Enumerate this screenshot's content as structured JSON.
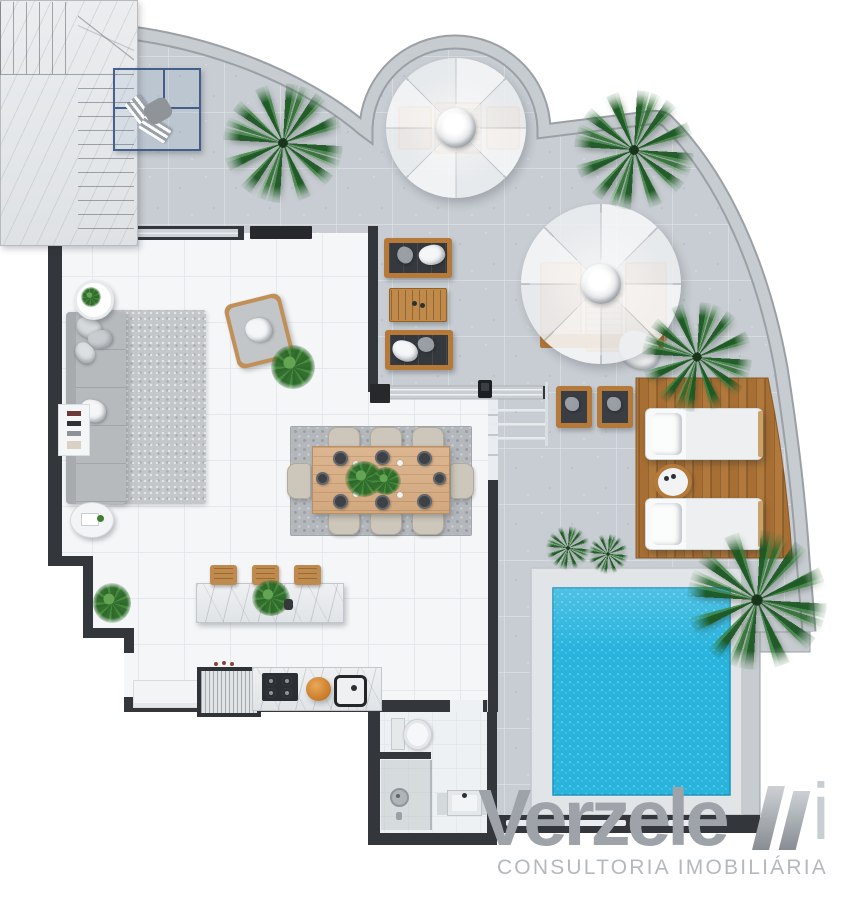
{
  "brand": {
    "full_name": "Verzeletti",
    "wordmark": "Verzele",
    "mark_suffix": "i",
    "tagline": "CONSULTORIA IMOBILIÁRIA"
  },
  "colors": {
    "pool-water": "#29b4de",
    "deck-wood": "#b2793c",
    "terrace-floor": "#c7cdd2",
    "interior-floor": "#f4f6f8",
    "wall-dark": "#33373b",
    "parapet": "#c7ccd0",
    "marble": "#e9ebee",
    "furniture-wood": "#bf8a4d",
    "palm-green": "#2e6b2b",
    "pergola-blue": "#3a5c8e",
    "umbrella-white": "#f4f5f6",
    "logo-gray": "#9da3a8"
  }
}
